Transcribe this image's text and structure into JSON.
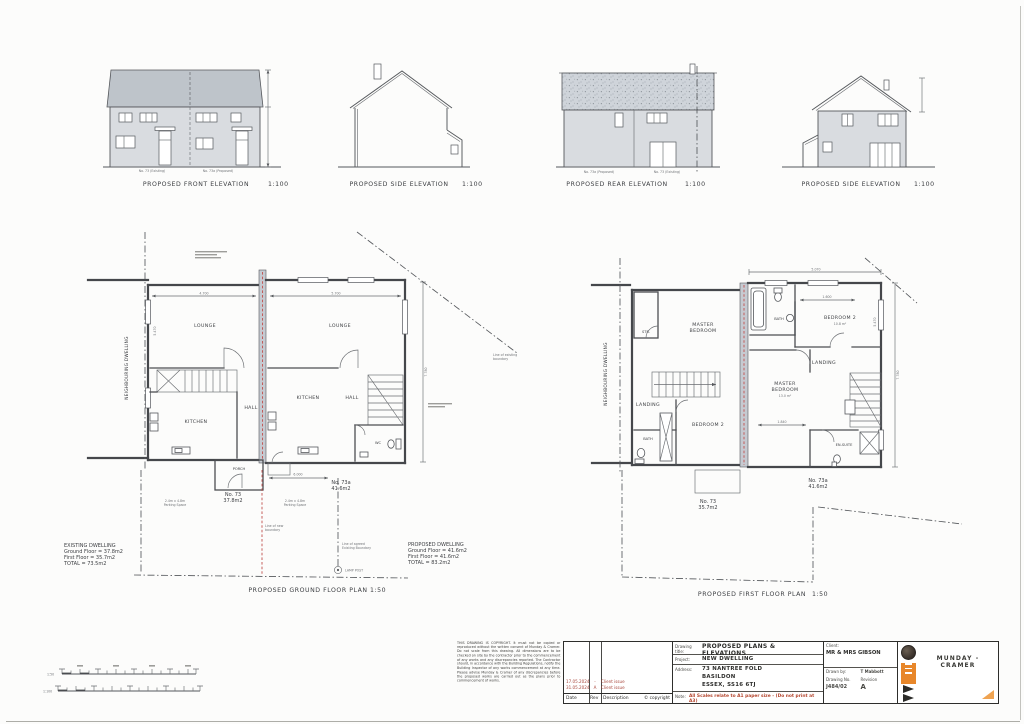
{
  "colors": {
    "accent_orange": "#e8872a",
    "note_red": "#b5472f",
    "revision_red": "#a8453a"
  },
  "elevations": {
    "front": {
      "title": "PROPOSED  FRONT  ELEVATION",
      "scale": "1:100",
      "left_label": "No. 73 (Existing)",
      "right_label": "No. 73a (Proposed)"
    },
    "side_left": {
      "title": "PROPOSED  SIDE  ELEVATION",
      "scale": "1:100"
    },
    "rear": {
      "title": "PROPOSED  REAR  ELEVATION",
      "scale": "1:100",
      "left_label": "No. 73a (Proposed)",
      "right_label": "No. 73 (Existing)"
    },
    "side_right": {
      "title": "PROPOSED  SIDE  ELEVATION",
      "scale": "1:100"
    }
  },
  "ground_floor": {
    "caption": "PROPOSED GROUND FLOOR PLAN",
    "scale": "1:50",
    "neighbour": "NEIGHBOURING DWELLING",
    "lounge_left": "LOUNGE",
    "kitchen_left": "KITCHEN",
    "hall_left": "HALL",
    "porch": "PORCH",
    "lounge_right": "LOUNGE",
    "kitchen_right": "KITCHEN",
    "hall_right": "HALL",
    "wc": "WC",
    "no73": "No. 73",
    "no73_area": "37.8m2",
    "no73a": "No. 73a",
    "no73a_area": "41.6m2",
    "dim_left": "4.700",
    "dim_right": "5.700",
    "dim_lounge": "5.470",
    "dim_height": "7.780",
    "dim_plot": "6.000",
    "parking1": "2.4m x 4.8m",
    "parking2": "Parking Space",
    "existing": {
      "l1": "EXISTING DWELLING",
      "l2": "Ground Floor = 37.8m2",
      "l3": "First Floor = 35.7m2",
      "l4": "TOTAL = 73.5m2"
    },
    "proposed": {
      "l1": "PROPOSED DWELLING",
      "l2": "Ground Floor = 41.6m2",
      "l3": "First Floor = 41.6m2",
      "l4": "TOTAL = 83.2m2"
    },
    "boundary_exist1": "Line of existing",
    "boundary_exist2": "boundary",
    "boundary_new1": "Line of new",
    "boundary_new2": "boundary",
    "boundary_agreed1": "Line of agreed",
    "boundary_agreed2": "Existing Boundary",
    "lamp": "LAMP POST"
  },
  "first_floor": {
    "caption": "PROPOSED FIRST FLOOR PLAN",
    "scale": "1:50",
    "neighbour": "NEIGHBOURING DWELLING",
    "str": "STR.",
    "master_left1": "MASTER",
    "master_left2": "BEDROOM",
    "landing_left": "LANDING",
    "bath_left": "BATH",
    "bed2_left": "BEDROOM 2",
    "bath_right": "BATH",
    "bed2_right": "BEDROOM 2",
    "bed2_right_area": "10.8 m²",
    "landing_right": "LANDING",
    "master_right1": "MASTER",
    "master_right2": "BEDROOM",
    "master_right_area": "13.0 m²",
    "ensuite": "EN-SUITE",
    "no73": "No. 73",
    "no73_area": "35.7m2",
    "no73a": "No. 73a",
    "no73a_area": "41.6m2",
    "dim_top": "5.070",
    "dim_bed2": "1.600",
    "dim_master": "1.840",
    "dim_right": "7.780",
    "dim_side": "5.470"
  },
  "scale_bars": {
    "top": "1:50",
    "bottom": "1:100"
  },
  "title_block": {
    "drawing_title_label": "Drawing title:",
    "drawing_title": "PROPOSED PLANS & ELEVATIONS",
    "project_label": "Project:",
    "project": "NEW DWELLING",
    "address_label": "Address:",
    "address1": "73 NANTREE FOLD",
    "address2": "BASILDON",
    "address3": "ESSEX, SS16 6TJ",
    "client_label": "Client:",
    "client": "MR & MRS GIBSON",
    "drawn_by_label": "Drawn by:",
    "drawn_by": "T Mabbott",
    "drawing_no_label": "Drawing No.",
    "drawing_no": "J484/02",
    "revision_label": "Revision",
    "revision": "A",
    "date_label": "Date",
    "rev_label": "Rev",
    "description_label": "Description",
    "copyright": "© copyright",
    "note_label": "Note:",
    "note": "All Scales relate to A1 paper size - (Do not print at A3)",
    "revisions": [
      {
        "date": "17.05.2024",
        "rev": "-",
        "desc": "Client issue"
      },
      {
        "date": "31.05.2024",
        "rev": "A",
        "desc": "Client issue"
      }
    ],
    "company": "MUNDAY - CRAMER",
    "disclaimer": "THIS DRAWING IS COPYRIGHT. It must not be copied or reproduced without the written consent of Munday & Cramer. Do not scale from this drawing. All dimensions are to be checked on site by the contractor prior to the commencement of any works and any discrepancies reported. The Contractor should, in accordance with the Building Regulations, notify the Building Inspector of any works commencement at any time. Please advise Munday & Cramer of any discrepancies before the proposed works are carried out as the plans prior to commencement of works."
  }
}
